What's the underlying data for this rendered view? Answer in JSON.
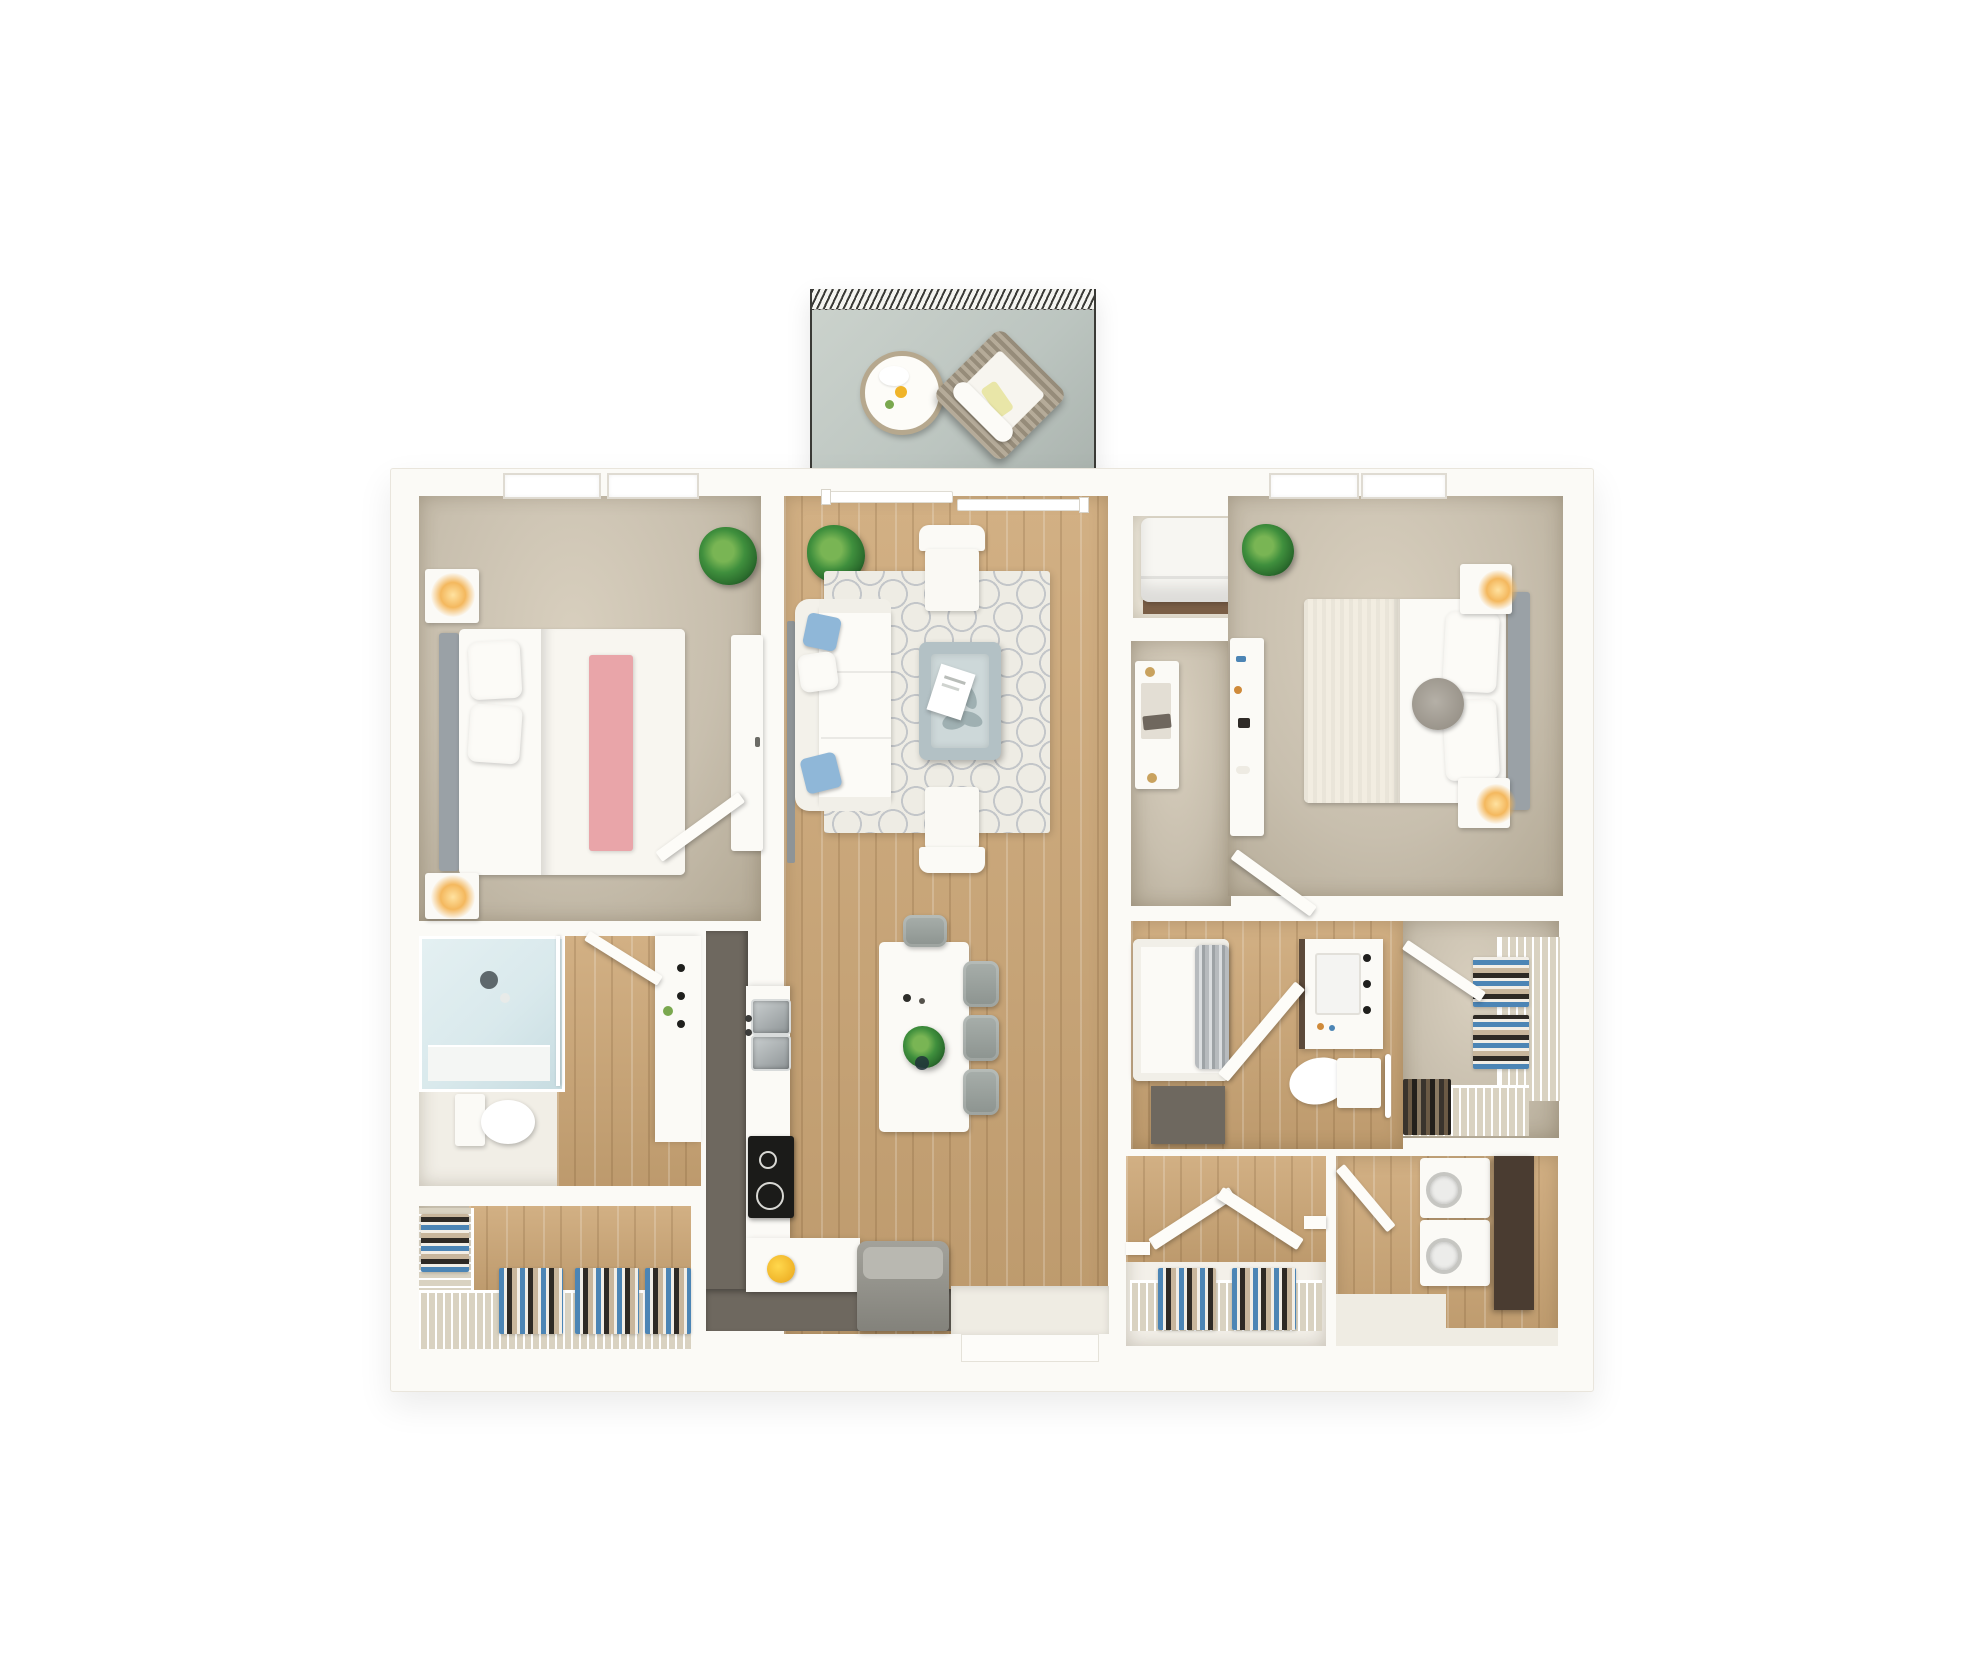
{
  "scene": {
    "description": "Top-down 3D architectural rendering of a two-bedroom two-bathroom apartment floor plan with a furnished balcony; no text labels are rendered in the image",
    "rooms": [
      {
        "name": "balcony",
        "floor": "gray outdoor deck with hatched awning edge",
        "furniture": [
          "round-side-table",
          "wicker-lounge-chair"
        ]
      },
      {
        "name": "bedroom-1",
        "floor": "beige carpet",
        "furniture": [
          "double-bed-with-pink-throw",
          "headboard",
          "nightstand-with-lamp-top",
          "nightstand-with-lamp-bottom",
          "dresser",
          "potted-plant"
        ],
        "windows": 2
      },
      {
        "name": "living-room",
        "floor": "light oak plank",
        "furniture": [
          "sliding-balcony-door",
          "sectional-sofa-with-blue-pillows",
          "armchair-top",
          "armchair-bottom",
          "coffee-table-with-tray",
          "patterned-area-rug",
          "wall-tv",
          "potted-plant"
        ]
      },
      {
        "name": "kitchen-dining",
        "floor": "light oak plank",
        "furniture": [
          "l-shaped-counter",
          "double-sink",
          "cooktop",
          "fruit-bowl",
          "refrigerator",
          "island-dining-table-with-plant",
          "dining-chairs-x4"
        ]
      },
      {
        "name": "bathroom-1",
        "floor": "oak and tile",
        "furniture": [
          "glass-shower",
          "toilet",
          "vanity-with-sink"
        ]
      },
      {
        "name": "closet-1",
        "floor": "oak",
        "furniture": [
          "wire-shelving",
          "hanging-clothes"
        ]
      },
      {
        "name": "utility-closet",
        "furniture": [
          "white-appliance"
        ]
      },
      {
        "name": "hallway",
        "floor": "beige carpet",
        "furniture": [
          "console-table"
        ]
      },
      {
        "name": "bedroom-2",
        "floor": "beige carpet",
        "furniture": [
          "double-bed",
          "headboard",
          "round-bolster-pillow",
          "nightstand-with-lamp-top",
          "nightstand-with-lamp-bottom",
          "desk-dresser",
          "potted-plant"
        ],
        "windows": 2
      },
      {
        "name": "bathroom-2",
        "floor": "oak",
        "furniture": [
          "bathtub-with-curtain",
          "vanity-with-sink",
          "toilet",
          "storage-cabinet",
          "towel-bar",
          "open-door"
        ]
      },
      {
        "name": "walk-in-closet",
        "floor": "beige carpet",
        "furniture": [
          "wire-shelving",
          "hanging-clothes",
          "open-door"
        ]
      },
      {
        "name": "coat-closet",
        "floor": "oak",
        "furniture": [
          "bifold-doors",
          "wire-shelf",
          "hanging-clothes"
        ]
      },
      {
        "name": "laundry-room",
        "floor": "oak",
        "furniture": [
          "stacked-washer",
          "stacked-dryer",
          "tall-brown-cabinet",
          "open-door"
        ]
      }
    ]
  },
  "palette": {
    "page-bg": "#ffffff",
    "wall": "#fbfaf6",
    "wall-edge": "#e9e5dc",
    "carpet": "#c8bfae",
    "carpet-dark": "#b2a894",
    "wood": "#cda776",
    "balcony-floor": "#bcc5c0",
    "balcony-border": "#3a3a36",
    "rug": "#eeece4",
    "rug-pattern": "#c3c6c9",
    "white-furniture": "#fbfaf6",
    "pillow-blue": "#8fb7d8",
    "throw-pink": "#e9a5a9",
    "headboard-gray": "#9aa1a6",
    "coffee-table": "#b3c1c5",
    "coffee-table-inner": "#cdd8d9",
    "chair-gray": "#8c938f",
    "counter-dark": "#6e685f",
    "appliance-gray": "#96958e",
    "cabinet-brown": "#4a3c31",
    "steel": "#8f9597",
    "steel-light": "#c9cecf",
    "stove-black": "#1b1b19",
    "glass-blue": "#d9e9ec",
    "curtain-gray": "#b7bbbe",
    "lamp-glow": "#f4b85e",
    "plant-green": "#3f8f3d",
    "clothes-blue": "#4c85b5",
    "clothes-tan": "#c8b69c",
    "clothes-black": "#2e2a25",
    "clothes-white": "#f2eee6",
    "wire-shelf-bg": "#d9d2c1",
    "entry-floor": "#efece3"
  }
}
